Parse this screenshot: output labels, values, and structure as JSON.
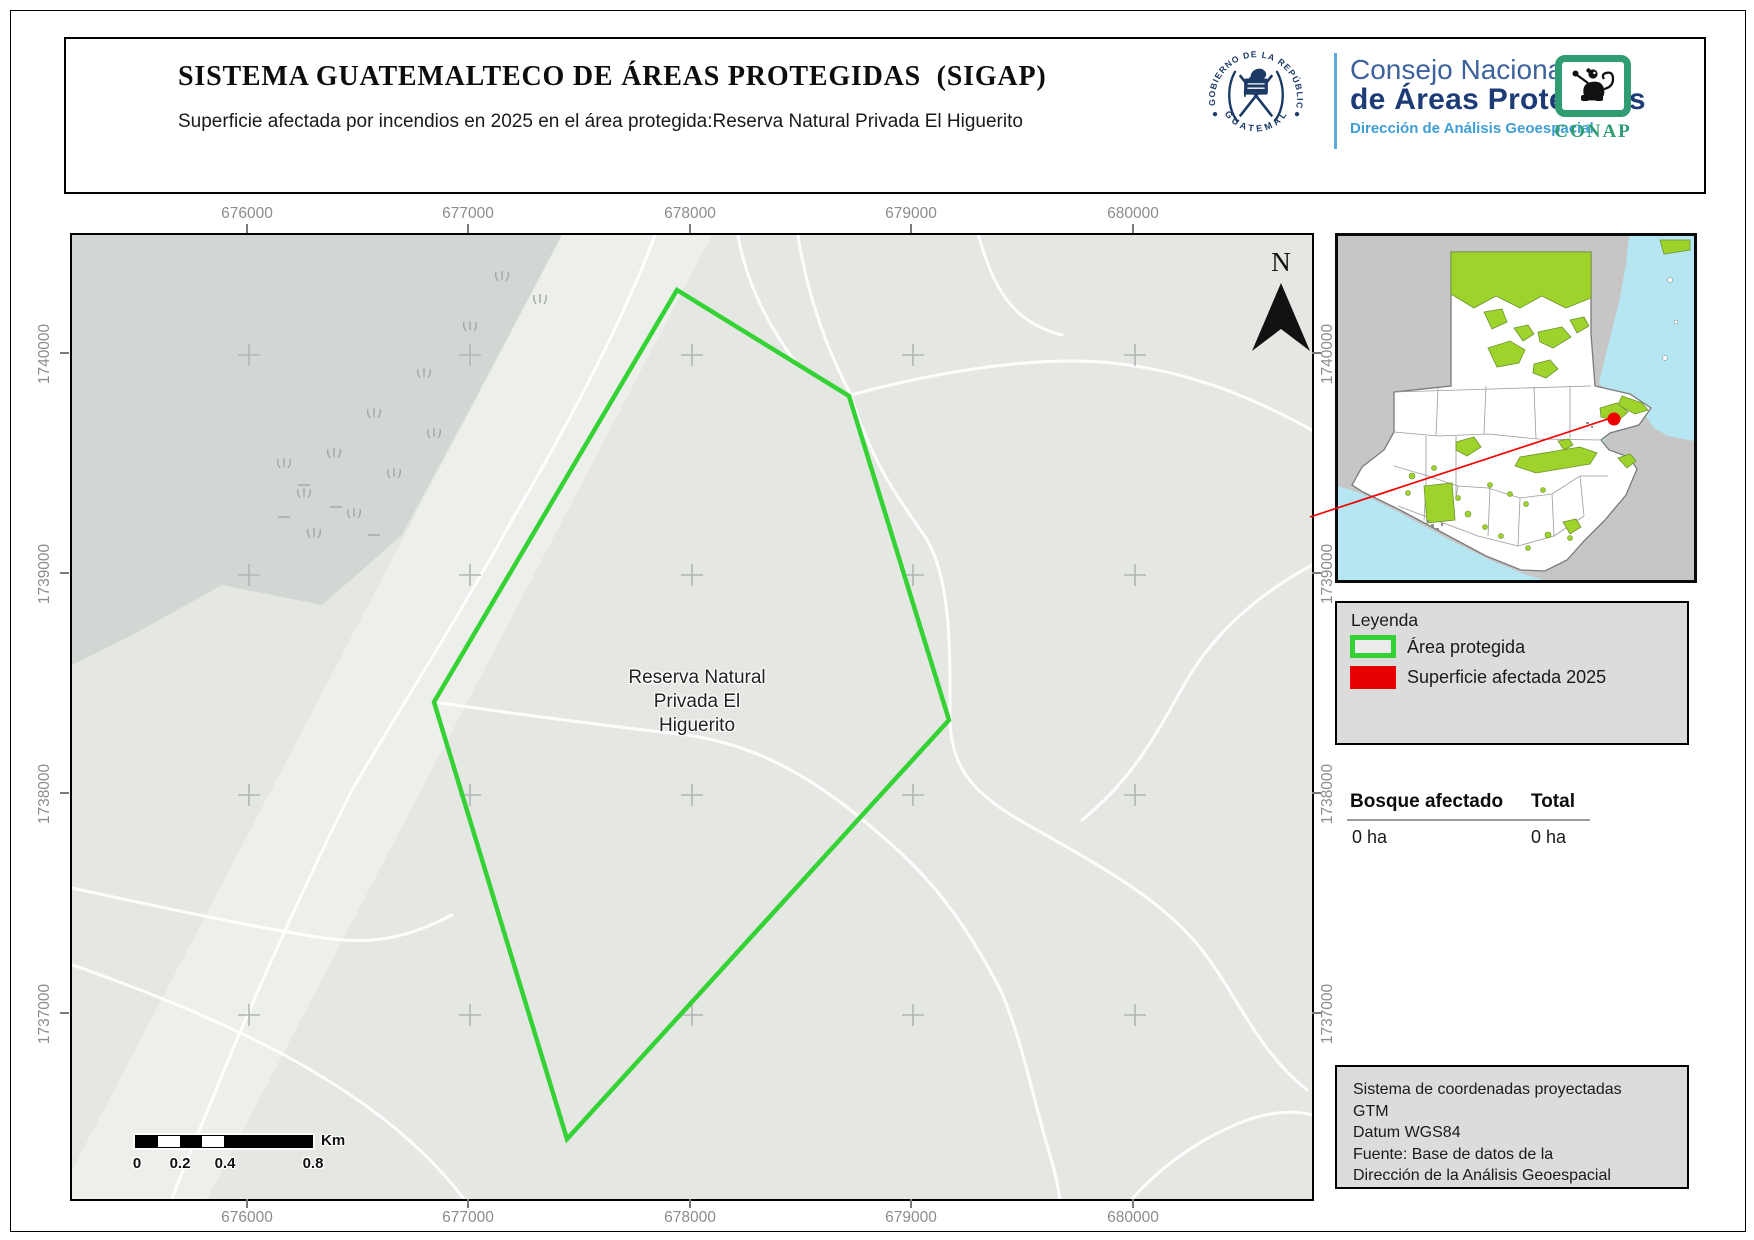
{
  "header": {
    "title": "SISTEMA GUATEMALTECO DE ÁREAS PROTEGIDAS  (SIGAP)",
    "subtitle": "Superficie afectada por incendios en 2025 en el área protegida:Reserva Natural Privada El Higuerito",
    "emblem": {
      "arc_top": "GOBIERNO DE LA REPÚBLICA",
      "arc_bottom": "GUATEMALA"
    },
    "org": {
      "line1": "Consejo Nacional",
      "line2": "de Áreas Protegidas",
      "line3": "Dirección de Análisis Geoespacial"
    },
    "conap_label": "CONAP"
  },
  "map": {
    "area_label_line1": "Reserva Natural",
    "area_label_line2": "Privada El",
    "area_label_line3": "Higuerito",
    "north_label": "N",
    "x_ticks": [
      "676000",
      "677000",
      "678000",
      "679000",
      "680000"
    ],
    "y_ticks": [
      "1740000",
      "1739000",
      "1738000",
      "1737000"
    ],
    "scalebar": {
      "labels": [
        "0",
        "0.2",
        "0.4",
        "0.8"
      ],
      "unit": "Km"
    }
  },
  "legend": {
    "title": "Leyenda",
    "items": [
      {
        "label": "Área protegida",
        "style": "outline",
        "color": "#35d235"
      },
      {
        "label": "Superficie afectada 2025",
        "style": "fill",
        "color": "#e60000"
      }
    ]
  },
  "stats": {
    "header_left": "Bosque afectado",
    "header_right": "Total",
    "value_left": "0 ha",
    "value_right": "0 ha"
  },
  "info_box": {
    "lines": [
      "Sistema de coordenadas proyectadas",
      "GTM",
      "Datum WGS84",
      "Fuente: Base de datos de la",
      "Dirección de la Análisis Geoespacial"
    ]
  },
  "colors": {
    "protected_outline": "#35d235",
    "affected_fill": "#e60000",
    "inset_protected": "#9ed32b",
    "inset_water": "#b5e6f2",
    "navy": "#1d3c77",
    "accent_blue": "#3f9ed6",
    "conap_green": "#2f9c72"
  }
}
